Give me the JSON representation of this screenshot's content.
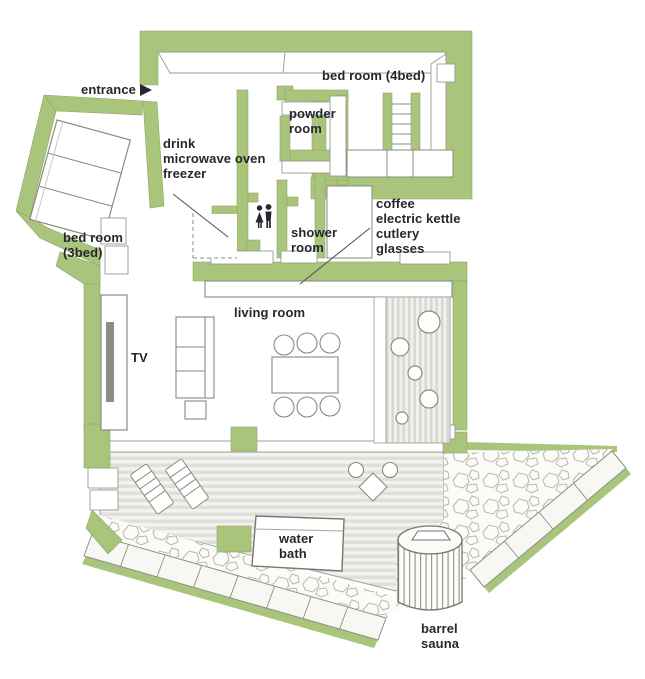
{
  "title": "holiday house floor plan",
  "palette": {
    "wall_green": "#a9c57b",
    "sketch_line": "#8a8a80",
    "text_color": "#26262e",
    "deck_stripe": "#e0e0db",
    "paver_fill": "#f7f7f4"
  },
  "labels": {
    "entrance": "entrance",
    "bedroom4": "bed room (4bed)",
    "powder_room": [
      "powder",
      "room"
    ],
    "kitchen_items": [
      "drink",
      "microwave oven",
      "freezer"
    ],
    "bedroom3": [
      "bed room",
      "(3bed)"
    ],
    "shower_room": [
      "shower",
      "room"
    ],
    "counter_items": [
      "coffee",
      "electric kettle",
      "cutlery",
      "glasses"
    ],
    "living_room": "living room",
    "tv": "TV",
    "water_bath": [
      "water",
      "bath"
    ],
    "barrel_sauna": [
      "barrel",
      "sauna"
    ]
  },
  "icons": {
    "entrance_arrow": "right-pointing-triangle",
    "restroom": "man-and-woman-pictograms"
  }
}
